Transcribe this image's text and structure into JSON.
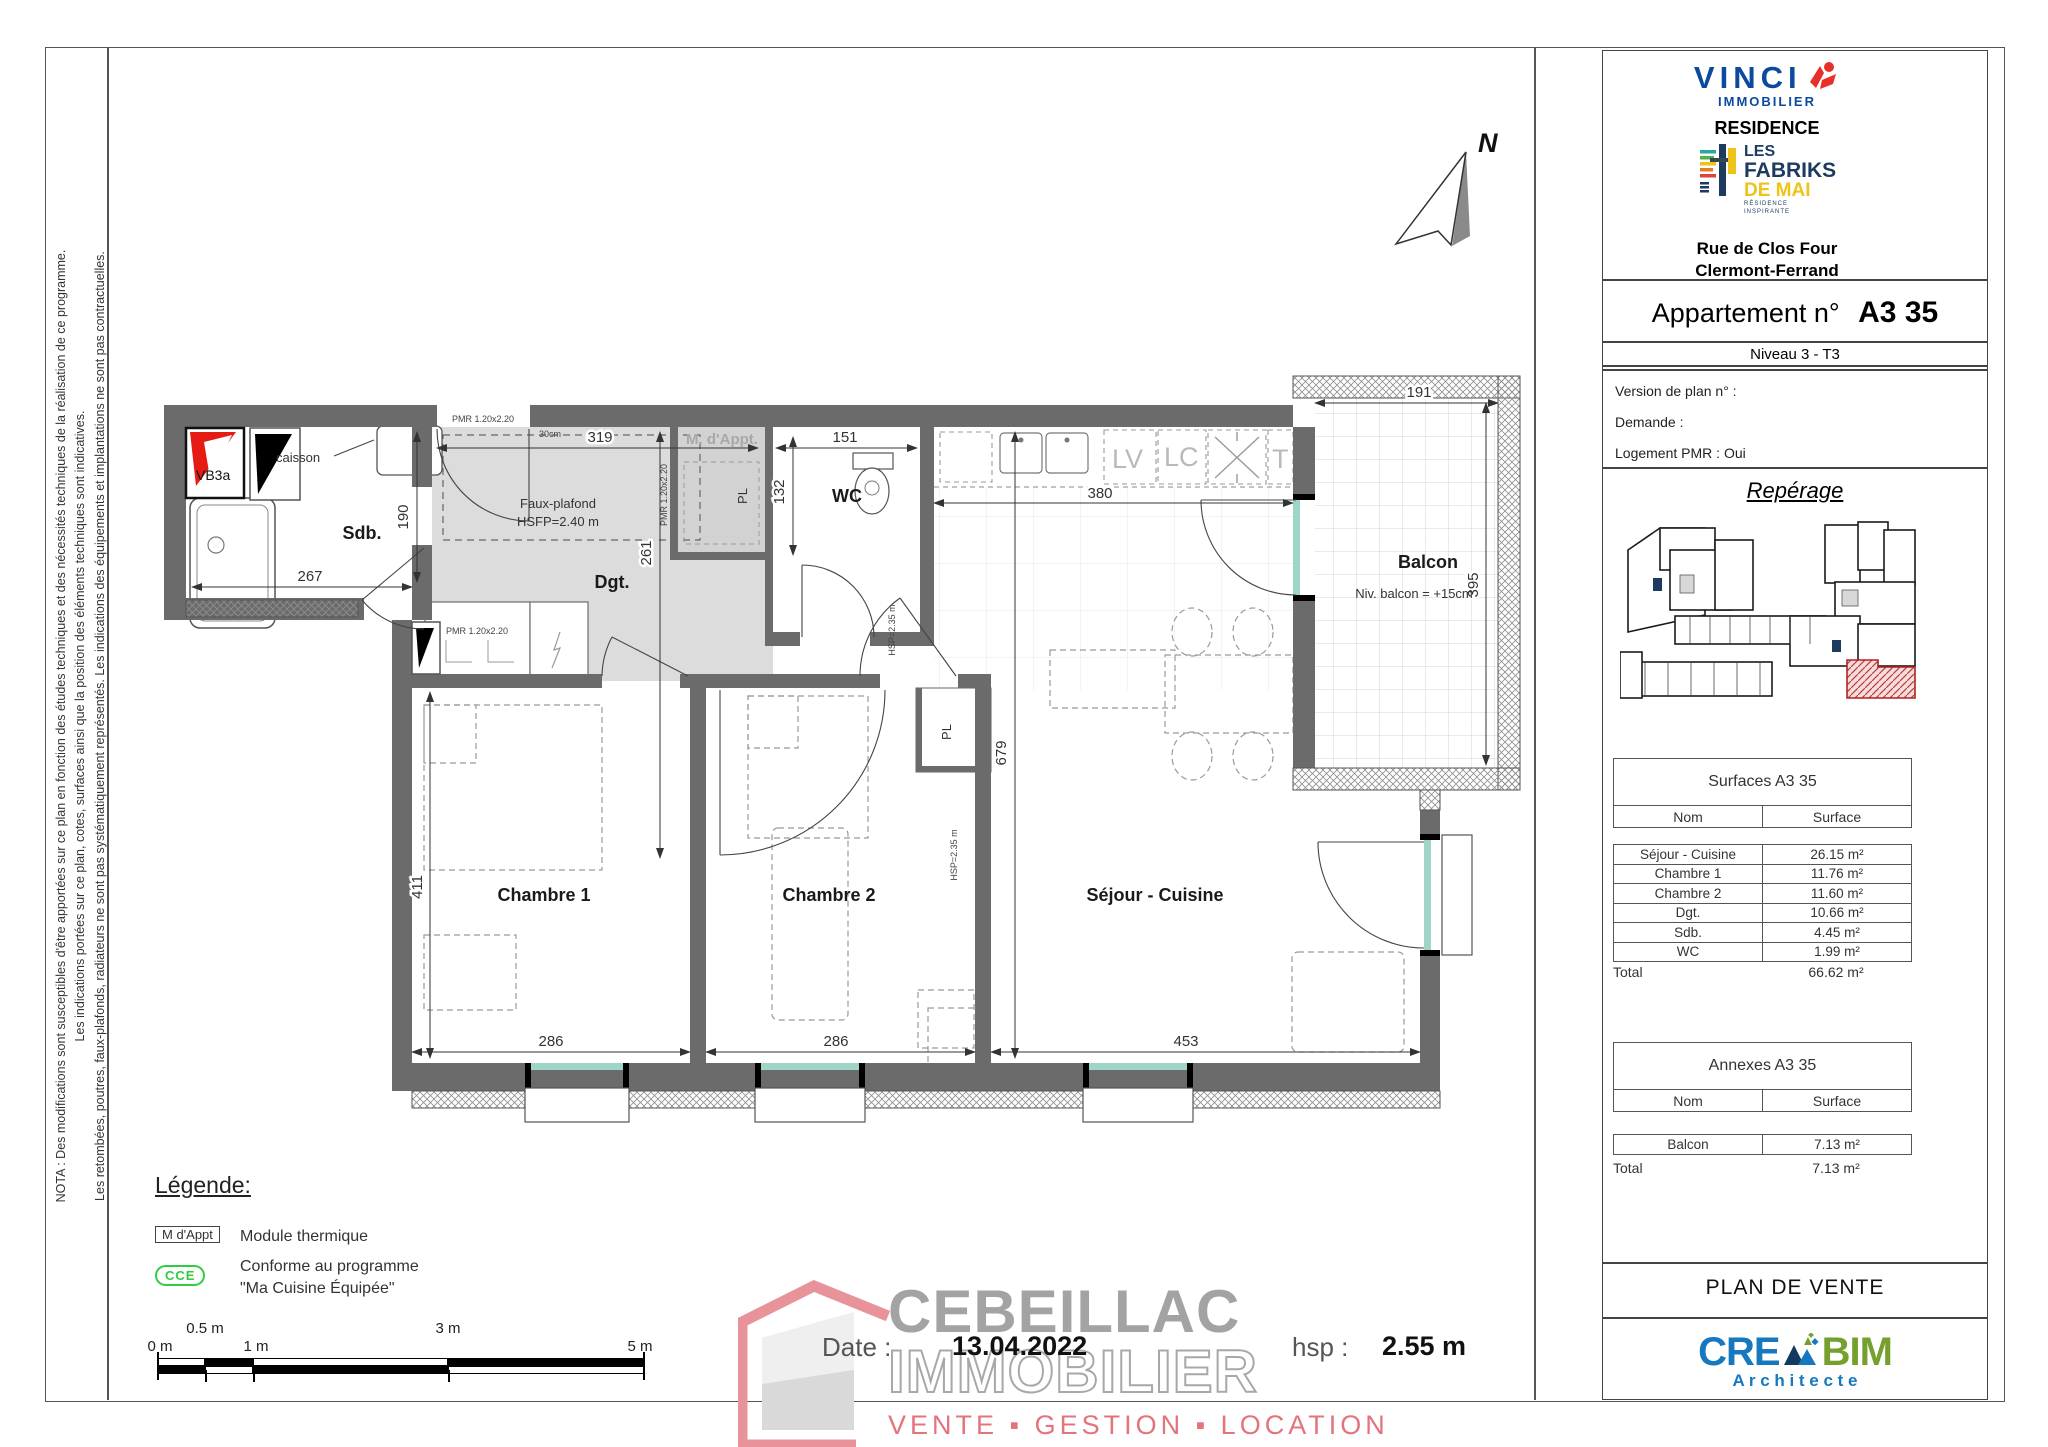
{
  "nota": {
    "line1": "NOTA : Des modifications sont susceptibles d'être apportées sur ce plan en fonction des études techniques et des nécessités techniques de la réalisation de ce programme.",
    "line2": "Les indications portées sur ce plan, cotes, surfaces ainsi que la position des éléments techniques sont indicatives.",
    "line3": "Les retombées, poutres, faux-plafonds, radiateurs ne sont pas systématiquement représentés. Les indications des équipements et implantations ne sont pas contractuelles."
  },
  "panel": {
    "vinci_name": "VINCI",
    "vinci_sub": "IMMOBILIER",
    "residence_label": "RESIDENCE",
    "fabriks_line1": "LES",
    "fabriks_line2": "FABRIKS",
    "fabriks_line3": "DE MAI",
    "fabriks_sub1": "RÉSIDENCE",
    "fabriks_sub2": "INSPIRANTE",
    "address_line1": "Rue de Clos Four",
    "address_line2": "Clermont-Ferrand",
    "apt_label": "Appartement  n°",
    "apt_number": "A3 35",
    "level": "Niveau 3 - T3",
    "version_label": "Version de plan  n° :",
    "demande_label": "Demande   :",
    "pmr_label": "Logement PMR :  Oui",
    "reperage_title": "Repérage",
    "surfaces": {
      "title": "Surfaces A3 35",
      "col_nom": "Nom",
      "col_surface": "Surface",
      "rows": [
        [
          "Séjour - Cuisine",
          "26.15 m²"
        ],
        [
          "Chambre 1",
          "11.76 m²"
        ],
        [
          "Chambre 2",
          "11.60 m²"
        ],
        [
          "Dgt.",
          "10.66 m²"
        ],
        [
          "Sdb.",
          "4.45 m²"
        ],
        [
          "WC",
          "1.99 m²"
        ]
      ],
      "total_label": "Total",
      "total_value": "66.62 m²"
    },
    "annexes": {
      "title": "Annexes A3 35",
      "col_nom": "Nom",
      "col_surface": "Surface",
      "rows": [
        [
          "Balcon",
          "7.13 m²"
        ]
      ],
      "total_label": "Total",
      "total_value": "7.13 m²"
    },
    "plan_de_vente": "PLAN DE VENTE",
    "creabim_cre": "CRE",
    "creabim_bim": "BIM",
    "creabim_sub": "A r c h i t e c t e"
  },
  "plan": {
    "north_label": "N",
    "rooms": {
      "sdb": "Sdb.",
      "dgt": "Dgt.",
      "wc": "WC",
      "chambre1": "Chambre 1",
      "chambre2": "Chambre 2",
      "sejour": "Séjour - Cuisine",
      "balcon": "Balcon",
      "module": "M. d'Appt.",
      "pl_a": "PL",
      "pl_b": "PL"
    },
    "dims": {
      "d267": "267",
      "d190": "190",
      "d319": "319",
      "d261": "261",
      "d132": "132",
      "d151": "151",
      "d380": "380",
      "d191": "191",
      "d395": "395",
      "d411": "411",
      "d286a": "286",
      "d286b": "286",
      "d453": "453",
      "d679": "679"
    },
    "notes": {
      "caisson": "caisson",
      "faux_plafond_1": "Faux-plafond",
      "faux_plafond_2": "HSFP=2.40 m",
      "vb3a": "VB3a",
      "niv_balcon": "Niv. balcon = +15cm",
      "hsp235_a": "HSP=2.35 m",
      "hsp235_b": "HSP=2.35 m",
      "pmr_door": "PMR 1.20x2.20",
      "pmr_closet": "PMR 1.20x2.20",
      "pmr_module": "PMR 1.20x2.20",
      "cm30": "30cm",
      "lv": "LV",
      "lc": "LC",
      "t": "T"
    }
  },
  "legend": {
    "title": "Légende:",
    "module_symbol": "M  d'Appt",
    "module_label": "Module thermique",
    "cce_symbol": "CCE",
    "cce_line1": "Conforme au programme",
    "cce_line2": "\"Ma Cuisine Équipée\""
  },
  "scalebar": {
    "labels": [
      "0 m",
      "0.5 m",
      "1 m",
      "3 m",
      "5 m"
    ]
  },
  "footer": {
    "date_label": "Date :",
    "date_value": "13.04.2022",
    "hsp_label": "hsp :",
    "hsp_value": "2.55 m"
  },
  "brand": {
    "name": "CEBEILLAC",
    "name2": "IMMOBILIER",
    "tagline": "VENTE ▪ GESTION ▪ LOCATION"
  }
}
